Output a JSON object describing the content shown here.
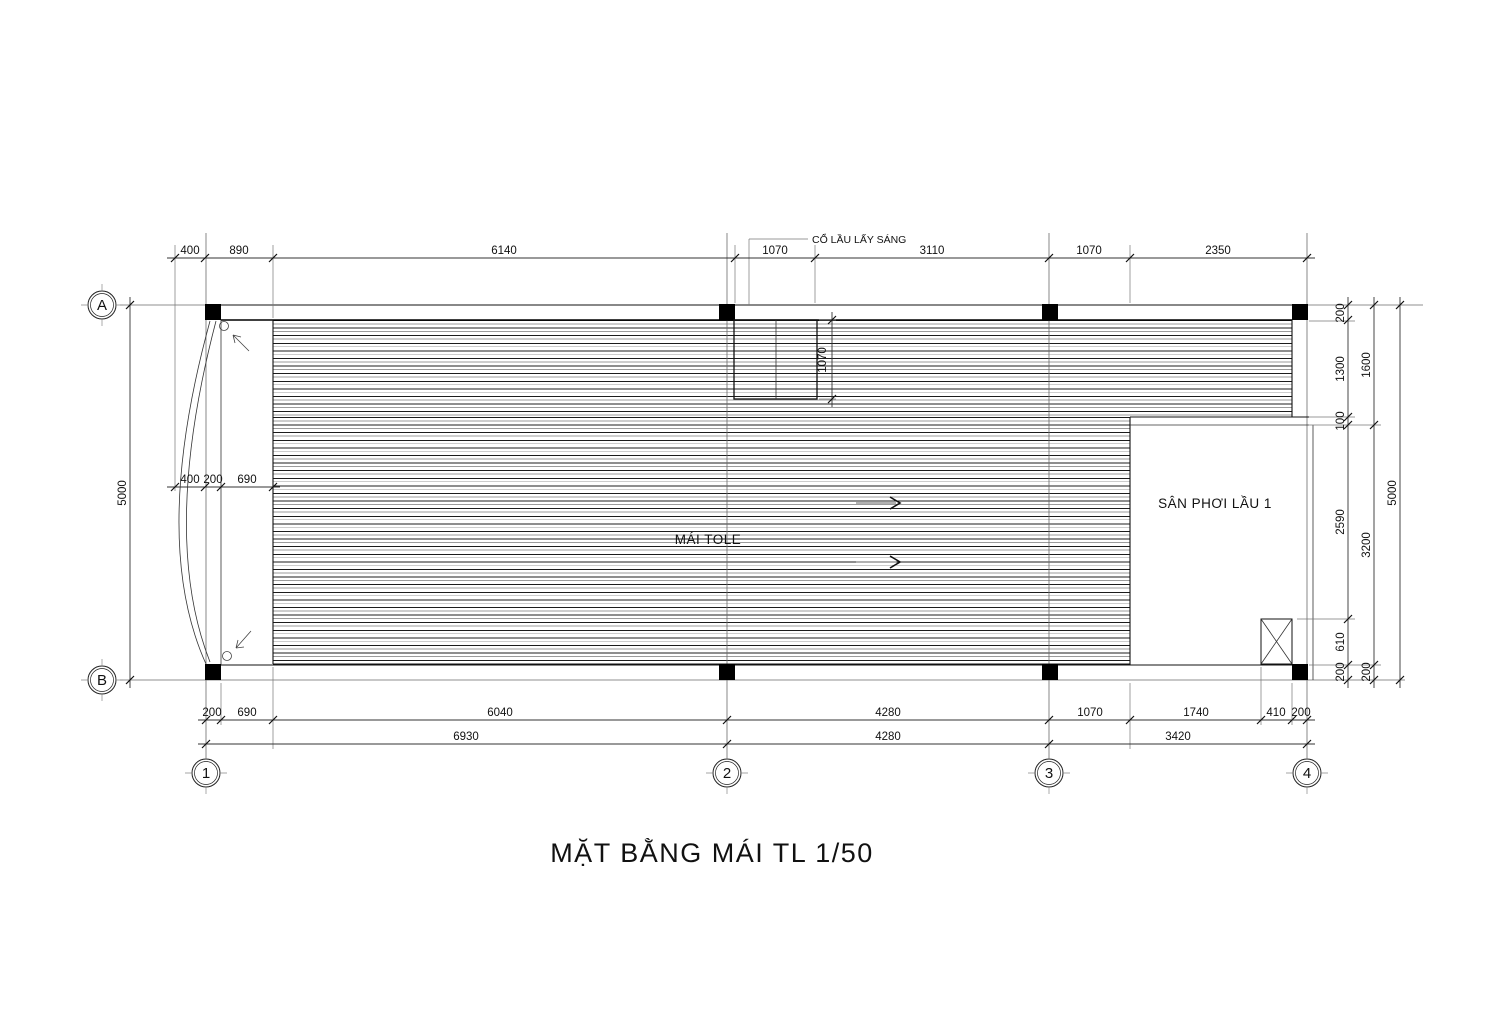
{
  "sheet": {
    "title": "MẶT BẰNG MÁI  TL 1/50"
  },
  "labels": {
    "roof": "MÁI TOLE",
    "terrace": "SÂN PHƠI LẦU 1",
    "skylight_note": "CỔ LẦU LẤY SÁNG"
  },
  "grid": {
    "cols": [
      "1",
      "2",
      "3",
      "4"
    ],
    "rows": [
      "A",
      "B"
    ]
  },
  "dims": {
    "top": [
      "400",
      "890",
      "6140",
      "1070",
      "3110",
      "1070",
      "2350"
    ],
    "bottom1": [
      "200",
      "690",
      "6040",
      "4280",
      "1070",
      "1740",
      "410",
      "200"
    ],
    "bottom2": [
      "6930",
      "4280",
      "3420"
    ],
    "left_outer": "5000",
    "left_inner": [
      "400",
      "200",
      "690"
    ],
    "right_inner": [
      "200",
      "1300",
      "100",
      "2590",
      "610",
      "200"
    ],
    "right_mid": [
      "1600",
      "3200",
      "200"
    ],
    "right_outer": "5000",
    "skylight": "1070"
  }
}
